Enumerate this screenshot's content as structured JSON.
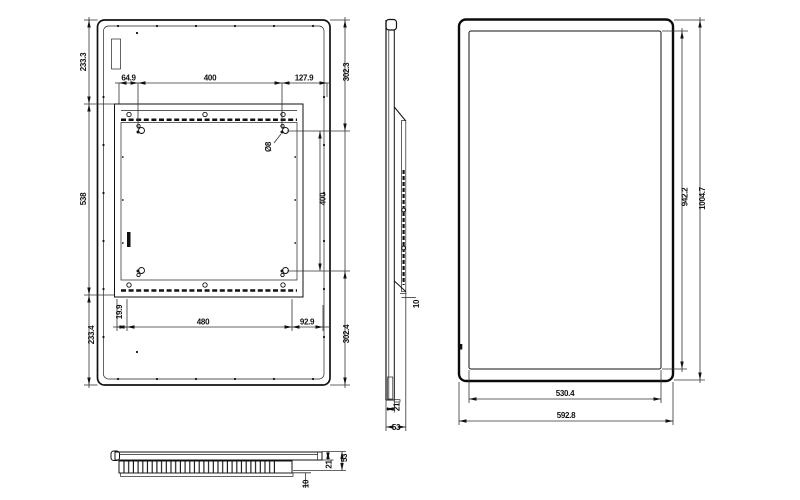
{
  "views": {
    "rear": {
      "dims": {
        "top_left": "64.9",
        "top_center": "400",
        "top_right": "127.9",
        "left_top": "233.3",
        "left_middle": "538",
        "left_bottom": "233.4",
        "right_top": "302.3",
        "right_middle": "400",
        "right_bottom": "302.4",
        "bottom_left": "19.9",
        "bottom_center": "480",
        "bottom_right": "92.9",
        "keyhole_diameter": "Ø8"
      }
    },
    "side": {
      "dims": {
        "bracket_offset": "10",
        "panel_thickness": "21",
        "total_depth": "53"
      }
    },
    "front": {
      "dims": {
        "screen_height": "942.2",
        "total_height": "1004.7",
        "screen_width": "530.4",
        "total_width": "592.8"
      }
    },
    "bottom": {
      "dims": {
        "total_depth": "53",
        "panel_thickness": "21",
        "vent_inset": "10"
      }
    }
  },
  "colors": {
    "line": "#111111",
    "background": "#ffffff"
  }
}
